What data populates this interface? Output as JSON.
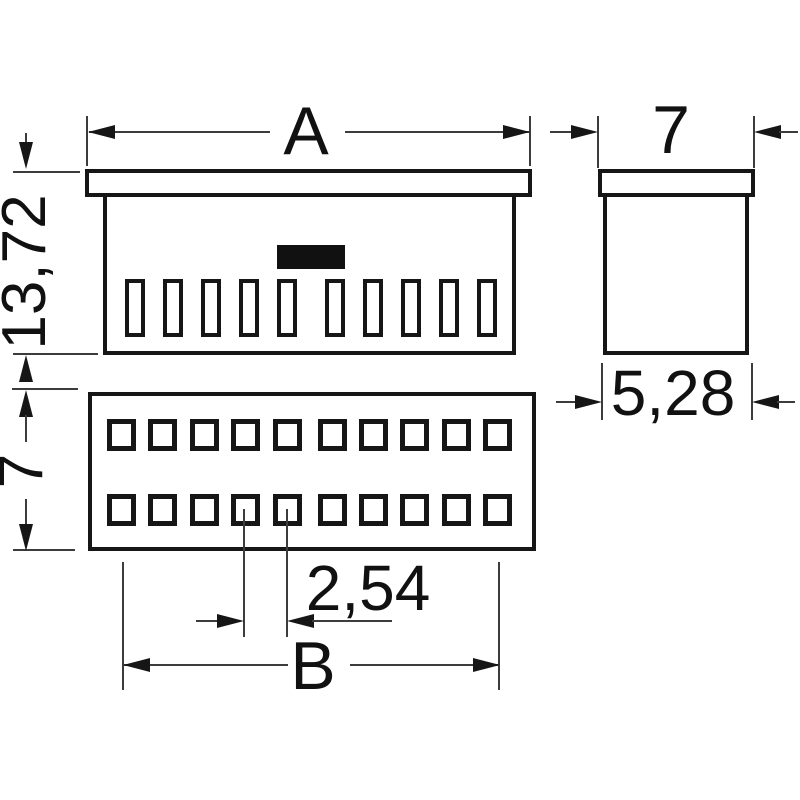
{
  "drawing": {
    "type": "technical-dimensional-drawing",
    "component": "dual-row connector / socket header",
    "views": {
      "front": {
        "slot_count": 10,
        "has_polarization_mark": true
      },
      "side": {
        "shown": true
      },
      "bottom": {
        "hole_rows": 2,
        "holes_per_row": 10
      }
    },
    "dimensions": {
      "overall_width": "A",
      "side_width": "7",
      "front_height": "13,72",
      "bottom_view_height": "7",
      "side_body_width": "5,28",
      "pitch": "2,54",
      "pin_span": "B"
    },
    "colors": {
      "outline": "#161616",
      "dimension_line": "#3c3c3c",
      "text": "#111111",
      "background": "#ffffff"
    }
  }
}
